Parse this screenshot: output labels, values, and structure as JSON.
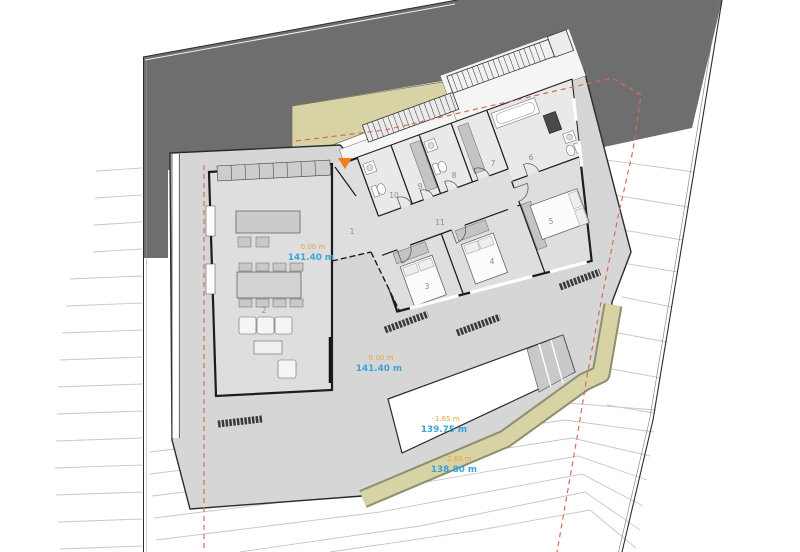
{
  "plan": {
    "type": "architectural-site-plan",
    "room_numbers": [
      "1",
      "2",
      "3",
      "4",
      "5",
      "6",
      "7",
      "8",
      "9",
      "10",
      "11"
    ],
    "elevations": {
      "living": {
        "relative": "0.00 m",
        "absolute": "141.40 m"
      },
      "terrace": {
        "relative": "0.00 m",
        "absolute": "141.40 m"
      },
      "pool": {
        "relative": "-1.65 m",
        "absolute": "139.75 m"
      },
      "garden": {
        "relative": "-2.60 m",
        "absolute": "138.80 m"
      }
    },
    "icons": {
      "entrance_marker": "entrance-arrow-icon"
    },
    "colors": {
      "neighbor_ground": "#6e6e6e",
      "terrace": "#d6d6d6",
      "interior": "#dedede",
      "interior_light": "#e9e9e9",
      "landscaping_band": "#d7d3a5",
      "pool": "#ffffff",
      "wall": "#1c1c1c",
      "contour": "#c7c7c7",
      "setback_line": "#d96a5a",
      "elevation_relative": "#e8a13c",
      "elevation_absolute": "#3aa3d8",
      "room_number": "#8c8c8c",
      "entrance_marker": "#f07d1e"
    }
  }
}
